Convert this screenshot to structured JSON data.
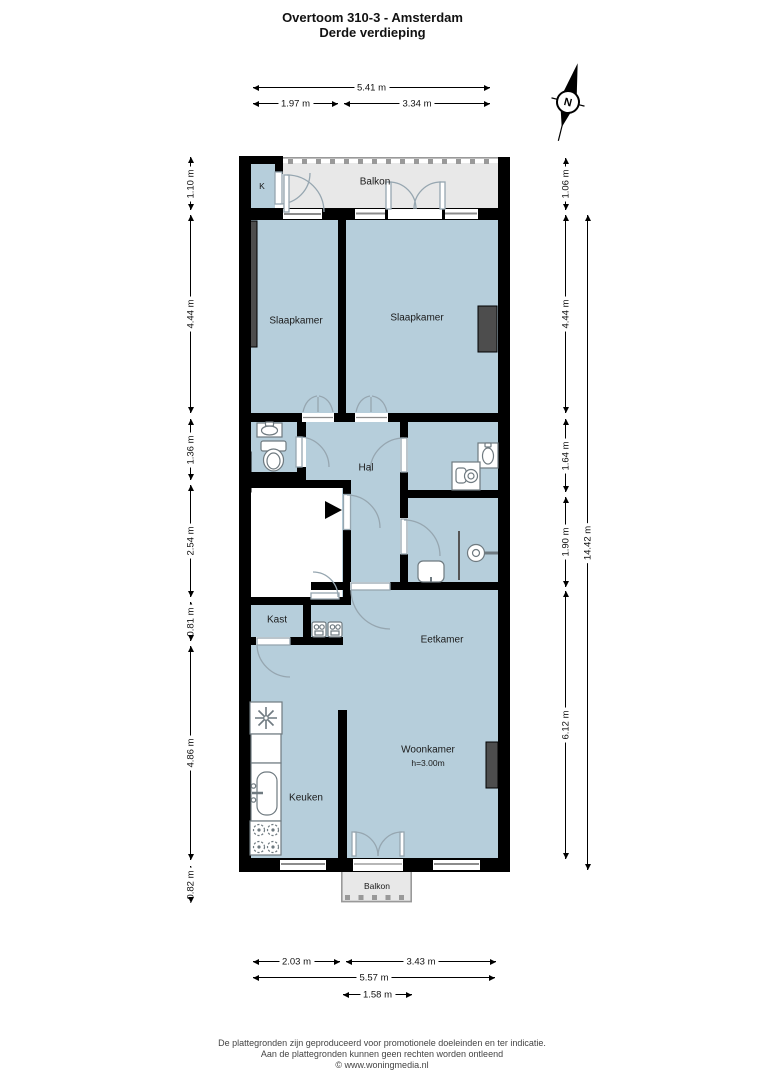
{
  "title": {
    "line1": "Overtoom 310-3 - Amsterdam",
    "line2": "Derde verdieping"
  },
  "compass": {
    "north_label": "N"
  },
  "rooms": {
    "k": "K",
    "balkon_top": "Balkon",
    "slaapkamer_left": "Slaapkamer",
    "slaapkamer_right": "Slaapkamer",
    "hal": "Hal",
    "kast": "Kast",
    "eetkamer": "Eetkamer",
    "keuken": "Keuken",
    "woonkamer": "Woonkamer",
    "woonkamer_height": "h=3.00m",
    "balkon_bottom": "Balkon"
  },
  "dimensions": {
    "top": [
      "5.41 m",
      "1.97 m",
      "3.34 m"
    ],
    "left": [
      "1.10 m",
      "4.44 m",
      "1.36 m",
      "2.54 m",
      "0.81 m",
      "4.86 m",
      "0.82 m"
    ],
    "right": [
      "1.06 m",
      "4.44 m",
      "1.64 m",
      "1.90 m",
      "6.12 m"
    ],
    "right_total": "14.42 m",
    "bottom": [
      "2.03 m",
      "3.43 m",
      "5.57 m",
      "1.58 m"
    ]
  },
  "footer": {
    "line1": "De plattegronden zijn geproduceerd voor promotionele doeleinden en ter indicatie.",
    "line2": "Aan de plattegronden kunnen geen rechten worden ontleend",
    "line3": "© www.woningmedia.nl"
  },
  "colors": {
    "room_fill": "#b6cedb",
    "balcony_fill": "#e8e8e8",
    "wall": "#000000",
    "dark": "#4d4d4d",
    "door": "#96a6b0",
    "fixture": "#6f7a80",
    "window_line": "#8c8c8c"
  }
}
